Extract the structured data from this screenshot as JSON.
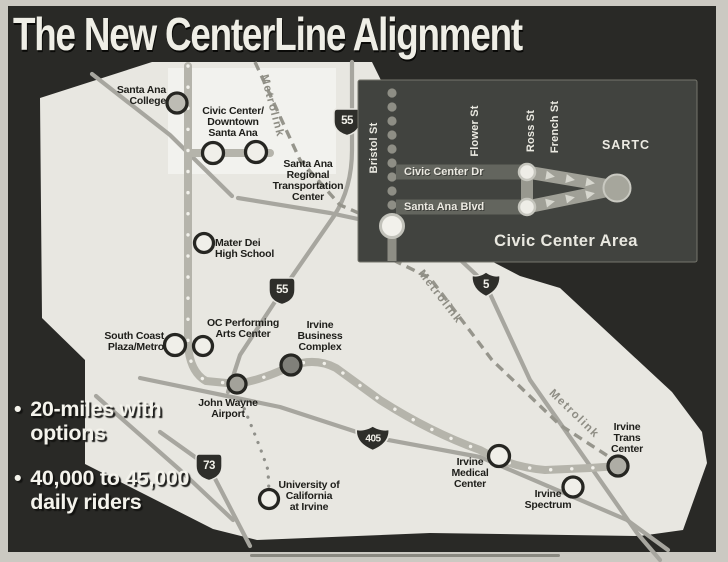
{
  "title": "The New CenterLine Alignment",
  "bullets": [
    {
      "marker": "•",
      "text": "20-miles with\noptions"
    },
    {
      "marker": "•",
      "text": "40,000 to 45,000\ndaily riders"
    }
  ],
  "map": {
    "rail_line_label": "Metrolink",
    "stations": [
      {
        "label": "Santa Ana\nCollege"
      },
      {
        "label": "Civic Center/\nDowntown\nSanta Ana"
      },
      {
        "label": "Santa Ana\nRegional\nTransportation\nCenter"
      },
      {
        "label": "Mater Dei\nHigh School"
      },
      {
        "label": "OC Performing\nArts Center"
      },
      {
        "label": "South Coast\nPlaza/Metro"
      },
      {
        "label": "Irvine\nBusiness\nComplex"
      },
      {
        "label": "John Wayne\nAirport"
      },
      {
        "label": "University of\nCalifornia\nat Irvine"
      },
      {
        "label": "Irvine\nMedical\nCenter"
      },
      {
        "label": "Irvine\nSpectrum"
      },
      {
        "label": "Irvine\nTrans\nCenter"
      }
    ],
    "highway_shields": [
      {
        "route": "55"
      },
      {
        "route": "55"
      },
      {
        "route": "5"
      },
      {
        "route": "405"
      },
      {
        "route": "73"
      }
    ]
  },
  "inset": {
    "title": "Civic Center Area",
    "terminal_label": "SARTC",
    "vertical_streets": [
      "Bristol St",
      "Flower St",
      "Ross St",
      "French St"
    ],
    "horizontal_streets": [
      "Civic Center Dr",
      "Santa Ana Blvd"
    ]
  },
  "colors": {
    "background": "#2a2a27",
    "map_fill": "#e8e7e1",
    "inset_panel": "#41433f",
    "road_gray": "#a7a69f",
    "text_light": "#f3f2ec",
    "text_dark": "#1e1e1a"
  }
}
